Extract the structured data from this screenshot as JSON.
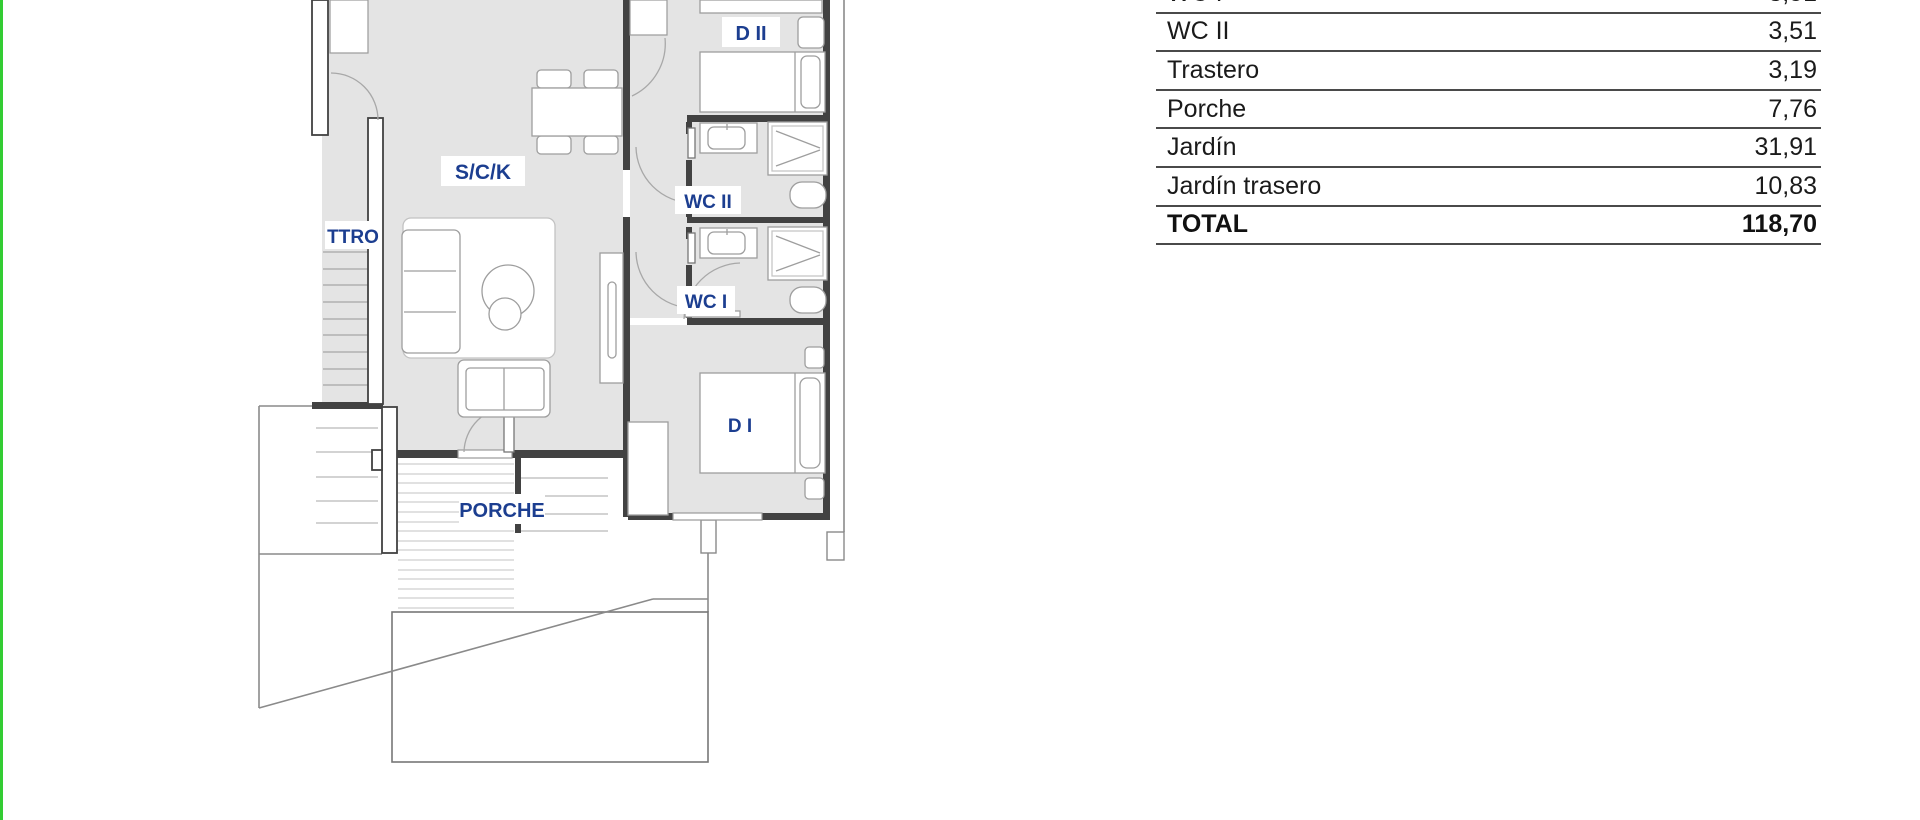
{
  "page": {
    "left_border_color": "#33cc33",
    "background": "#ffffff"
  },
  "floorplan": {
    "labels": {
      "bedroom2": "D II",
      "living": "S/C/K",
      "storage": "TTRO",
      "bathroom2": "WC II",
      "bathroom1": "WC I",
      "bedroom1": "D I",
      "porch": "PORCHE"
    },
    "colors": {
      "room_fill": "#e4e4e4",
      "wall": "#424242",
      "label_text": "#1c3e90"
    }
  },
  "area_table": {
    "rows": [
      {
        "label": "WC I",
        "value": "3,51"
      },
      {
        "label": "WC II",
        "value": "3,51"
      },
      {
        "label": "Trastero",
        "value": "3,19"
      },
      {
        "label": "Porche",
        "value": "7,76"
      },
      {
        "label": "Jardín",
        "value": "31,91"
      },
      {
        "label": "Jardín trasero",
        "value": "10,83"
      }
    ],
    "total": {
      "label": "TOTAL",
      "value": "118,70"
    }
  }
}
